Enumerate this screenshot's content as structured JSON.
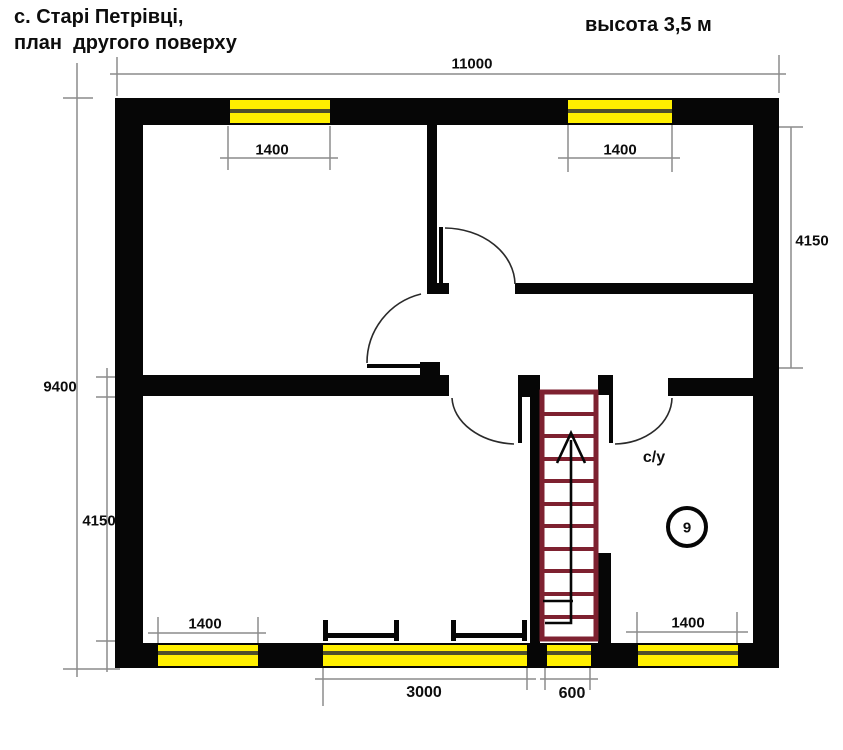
{
  "header": {
    "title_line1": "с. Старі Петрівці,",
    "title_line2": "план  другого поверху",
    "height_note": "высота 3,5 м"
  },
  "labels": {
    "bathroom": "с/у",
    "room_number": "9"
  },
  "dimensions": {
    "overall_width": "11000",
    "overall_depth": "9400",
    "upper_room_depth": "4150",
    "lower_room_depth": "4150",
    "window_top_left": "1400",
    "window_top_right": "1400",
    "window_bottom_left": "1400",
    "window_bottom_right": "1400",
    "window_bottom_center": "3000",
    "stair_window": "600"
  },
  "colors": {
    "wall": "#060606",
    "window": "#ffef00",
    "window_frame": "#4f4f2c",
    "stairs": "#7e2130",
    "dimension_line": "#8c8c8c",
    "text": "#0d0d0d",
    "background": "#ffffff"
  }
}
